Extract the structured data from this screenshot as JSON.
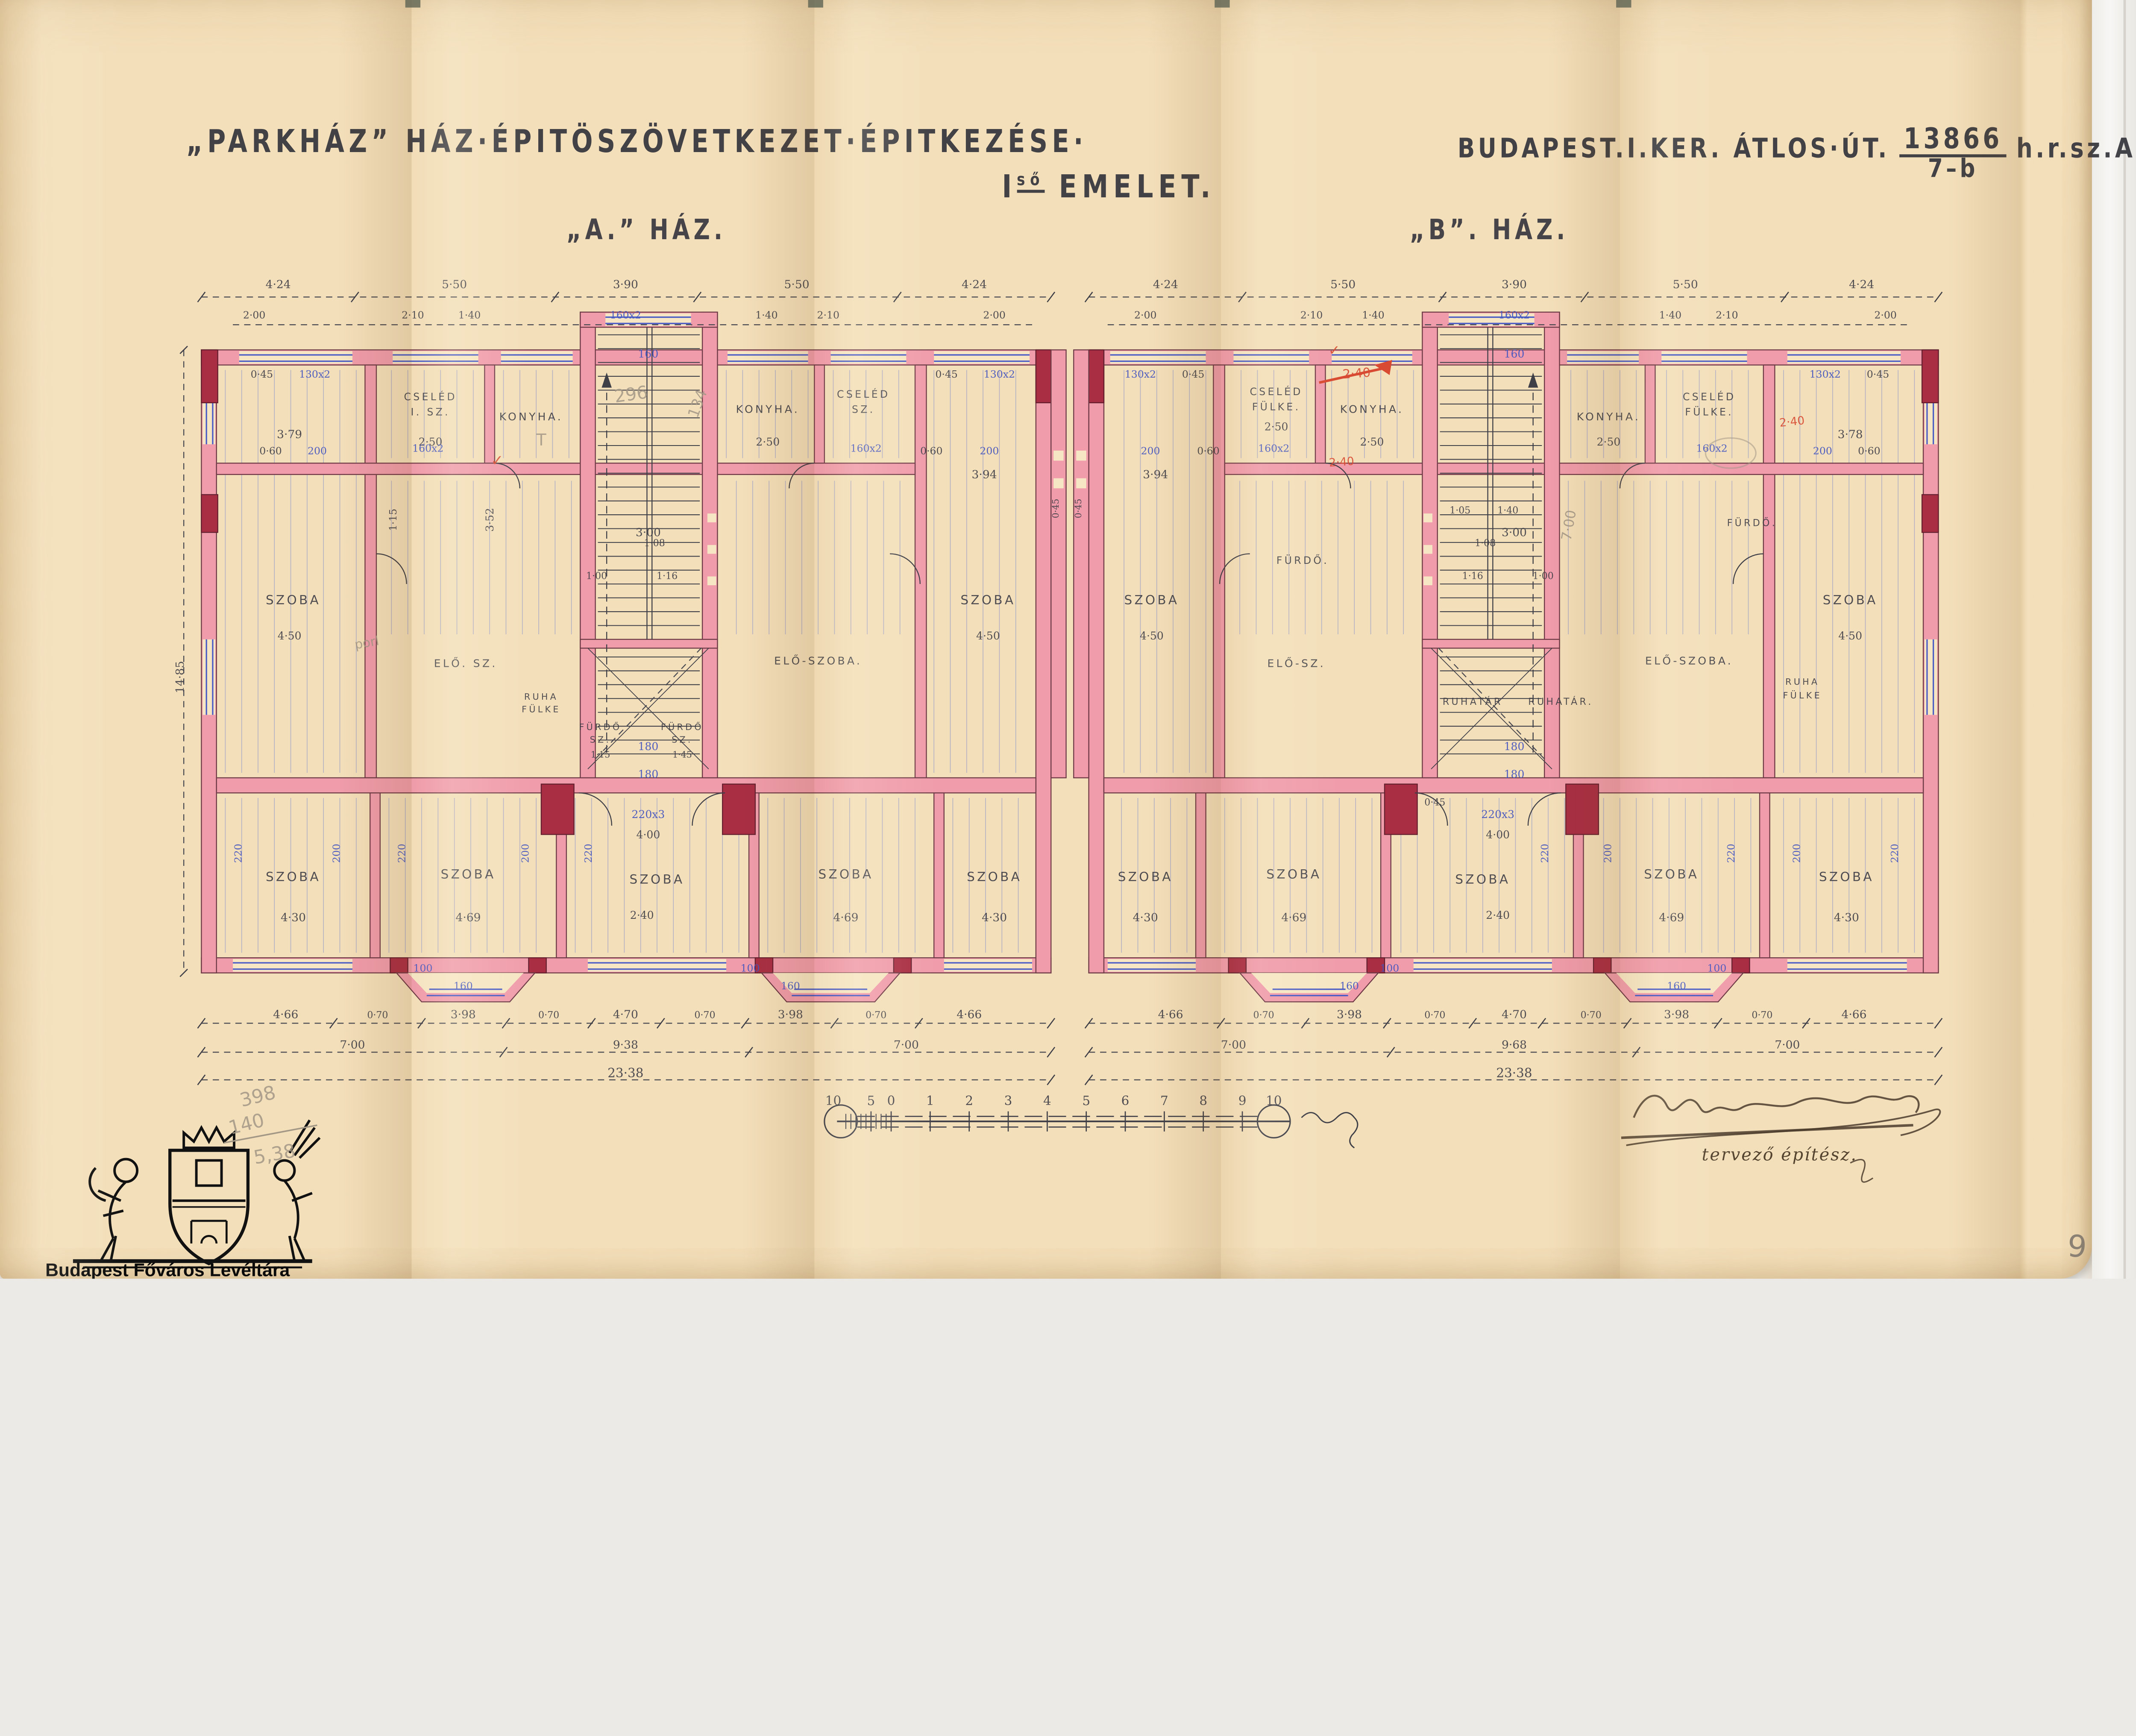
{
  "page": {
    "archive_name": "Budapest Főváros Levéltára",
    "page_number": "9"
  },
  "header": {
    "title": "„PARKHÁZ” HÁZ·ÉPITÖSZÖVETKEZET·ÉPITKEZÉSE·",
    "address": "BUDAPEST.I.KER. ÁTLOS·ÚT.",
    "lot_numerator": "13866",
    "lot_denominator": "7–b",
    "address_suffix": "h.r.sz.A.",
    "floor_main": "I",
    "floor_sup": "ső",
    "floor_rest": "EMELET.",
    "house_a": "„A.” HÁZ.",
    "house_b": "„B”. HÁZ."
  },
  "signature": {
    "role": "tervező építész."
  },
  "pencil_notes": {
    "lines": [
      "398",
      "140",
      "5,38"
    ]
  },
  "scale_bar": {
    "ticks": [
      "10",
      "5",
      "0",
      "1",
      "2",
      "3",
      "4",
      "5",
      "6",
      "7",
      "8",
      "9",
      "10"
    ]
  },
  "plan_labels": [
    [
      "SZOBA",
      103,
      272,
      "m",
      10
    ],
    [
      "SZOBA",
      655,
      272,
      "m",
      10
    ],
    [
      "SZOBA",
      103,
      492,
      "m",
      10
    ],
    [
      "SZOBA",
      242,
      490,
      "m",
      10
    ],
    [
      "SZOBA",
      392,
      494,
      "m",
      10
    ],
    [
      "SZOBA",
      542,
      490,
      "m",
      10
    ],
    [
      "SZOBA",
      660,
      492,
      "m",
      10
    ],
    [
      "CSELÉD",
      212,
      110,
      "m",
      8
    ],
    [
      "I. SZ.",
      212,
      122,
      "m",
      8
    ],
    [
      "KONYHA.",
      292,
      126,
      "m",
      8.5
    ],
    [
      "KONYHA.",
      480,
      120,
      "m",
      8.5
    ],
    [
      "CSELÉD",
      556,
      108,
      "m",
      8
    ],
    [
      "SZ.",
      556,
      120,
      "m",
      8
    ],
    [
      "ELŐ. SZ.",
      240,
      322,
      "m",
      8.5
    ],
    [
      "ELŐ-SZOBA.",
      520,
      320,
      "m",
      8.5
    ],
    [
      "FÜRDŐ",
      347,
      372,
      "m",
      7
    ],
    [
      "SZ.",
      347,
      382,
      "m",
      7
    ],
    [
      "FÜRDŐ",
      412,
      372,
      "m",
      7
    ],
    [
      "SZ.",
      412,
      382,
      "m",
      7
    ],
    [
      "RUHA",
      300,
      348,
      "m",
      7
    ],
    [
      "FÜLKE",
      300,
      358,
      "m",
      7
    ],
    [
      "4·24",
      91,
      21
    ],
    [
      "5·50",
      231,
      21
    ],
    [
      "3·90",
      367,
      21
    ],
    [
      "5·50",
      503,
      21
    ],
    [
      "4·24",
      644,
      21
    ],
    [
      "2·00",
      72,
      45,
      "k",
      8
    ],
    [
      "2·10",
      198,
      45,
      "k",
      8
    ],
    [
      "1·40",
      243,
      45,
      "k",
      8
    ],
    [
      "1·40",
      479,
      45,
      "k",
      8
    ],
    [
      "2·10",
      528,
      45,
      "k",
      8
    ],
    [
      "2·00",
      660,
      45,
      "k",
      8
    ],
    [
      "0·45",
      78,
      92,
      "k",
      8
    ],
    [
      "0·45",
      622,
      92,
      "k",
      8
    ],
    [
      "3·79",
      100,
      140
    ],
    [
      "2·50",
      212,
      146,
      "k",
      8.5
    ],
    [
      "2·50",
      480,
      146,
      "k",
      8.5
    ],
    [
      "3·52",
      262,
      205,
      "k",
      8.5,
      -90
    ],
    [
      "1·15",
      185,
      205,
      "k",
      8,
      -90
    ],
    [
      "3·00",
      385,
      218
    ],
    [
      "0·60",
      85,
      153,
      "k",
      8
    ],
    [
      "0·60",
      610,
      153,
      "k",
      8
    ],
    [
      "3·94",
      652,
      172
    ],
    [
      "4·50",
      100,
      300,
      "k",
      8.5
    ],
    [
      "4·50",
      655,
      300,
      "k",
      8.5
    ],
    [
      "1·08",
      390,
      226,
      "k",
      7.5
    ],
    [
      "1·00",
      344,
      252,
      "k",
      7.5
    ],
    [
      "1·16",
      400,
      252,
      "k",
      7.5
    ],
    [
      "1·15",
      347,
      394,
      "k",
      7
    ],
    [
      "1·45",
      412,
      394,
      "k",
      7
    ],
    [
      "4·00",
      385,
      458,
      "k",
      8.5
    ],
    [
      "4·30",
      103,
      524
    ],
    [
      "4·69",
      242,
      524
    ],
    [
      "2·40",
      380,
      522,
      "k",
      8.5
    ],
    [
      "4·69",
      542,
      524
    ],
    [
      "4·30",
      660,
      524
    ],
    [
      "4·66",
      97,
      601
    ],
    [
      "0·70",
      170,
      601,
      "k",
      7.5
    ],
    [
      "3·98",
      238,
      601
    ],
    [
      "0·70",
      306,
      601,
      "k",
      7.5
    ],
    [
      "4·70",
      367,
      601
    ],
    [
      "0·70",
      430,
      601,
      "k",
      7.5
    ],
    [
      "3·98",
      498,
      601
    ],
    [
      "0·70",
      566,
      601,
      "k",
      7.5
    ],
    [
      "4·66",
      640,
      601
    ],
    [
      "7·00",
      150,
      625
    ],
    [
      "9·38",
      367,
      625
    ],
    [
      "7·00",
      590,
      625
    ],
    [
      "23·38",
      367,
      648,
      "k",
      10
    ],
    [
      "14·85",
      16,
      330,
      "k",
      9,
      -90
    ],
    [
      "0·45",
      711,
      196,
      "k",
      7,
      -90
    ],
    [
      "0·45",
      729,
      196,
      "k",
      7,
      -90
    ],
    [
      "130x2",
      120,
      92,
      "b",
      8
    ],
    [
      "130x2",
      664,
      92,
      "b",
      8
    ],
    [
      "160x2",
      367,
      45,
      "b",
      8
    ],
    [
      "200",
      122,
      153,
      "b",
      8
    ],
    [
      "160x2",
      210,
      151,
      "b",
      8
    ],
    [
      "160x2",
      558,
      151,
      "b",
      8
    ],
    [
      "200",
      656,
      153,
      "b",
      8
    ],
    [
      "160",
      385,
      76,
      "b",
      8.5
    ],
    [
      "180",
      385,
      388,
      "b",
      8.5
    ],
    [
      "180",
      385,
      410,
      "b",
      8.5
    ],
    [
      "220x3",
      385,
      442,
      "b",
      8.5
    ],
    [
      "220",
      62,
      470,
      "b",
      8,
      -90
    ],
    [
      "200",
      140,
      470,
      "b",
      8,
      -90
    ],
    [
      "220",
      192,
      470,
      "b",
      8,
      -90
    ],
    [
      "200",
      290,
      470,
      "b",
      8,
      -90
    ],
    [
      "220",
      340,
      470,
      "b",
      8,
      -90
    ],
    [
      "160",
      238,
      578,
      "b",
      8
    ],
    [
      "100",
      206,
      564,
      "b",
      8
    ],
    [
      "160",
      498,
      578,
      "b",
      8
    ],
    [
      "100",
      466,
      564,
      "b",
      8
    ],
    [
      "296",
      372,
      110,
      "p",
      14,
      -8
    ],
    [
      "134",
      428,
      114,
      "p",
      12,
      -70
    ],
    [
      "T",
      300,
      146,
      "p",
      13
    ],
    [
      "porl",
      162,
      306,
      "p",
      10,
      -10
    ],
    [
      "✓",
      265,
      162,
      "r",
      12
    ],
    [
      "SZOBA",
      1340,
      272,
      "m",
      10
    ],
    [
      "SZOBA",
      785,
      272,
      "m",
      10
    ],
    [
      "SZOBA",
      1337,
      492,
      "m",
      10
    ],
    [
      "SZOBA",
      1198,
      490,
      "m",
      10
    ],
    [
      "SZOBA",
      1048,
      494,
      "m",
      10
    ],
    [
      "SZOBA",
      898,
      490,
      "m",
      10
    ],
    [
      "SZOBA",
      780,
      492,
      "m",
      10
    ],
    [
      "CSELÉD",
      884,
      106,
      "m",
      8
    ],
    [
      "FÜLKE.",
      884,
      118,
      "m",
      8
    ],
    [
      "KONYHA.",
      960,
      120,
      "m",
      8.5
    ],
    [
      "KONYHA.",
      1148,
      126,
      "m",
      8.5
    ],
    [
      "CSELÉD",
      1228,
      110,
      "m",
      8
    ],
    [
      "FÜLKE.",
      1228,
      122,
      "m",
      8
    ],
    [
      "FÜRDŐ.",
      905,
      240,
      "m",
      8
    ],
    [
      "FÜRDŐ.",
      1262,
      210,
      "m",
      7.5
    ],
    [
      "ELŐ-SZ.",
      900,
      322,
      "m",
      8.5
    ],
    [
      "ELŐ-SZOBA.",
      1212,
      320,
      "m",
      8.5
    ],
    [
      "RUHATÁR",
      1040,
      352,
      "m",
      7.5
    ],
    [
      "RUHATÁR.",
      1110,
      352,
      "m",
      7.5
    ],
    [
      "RUHA",
      1302,
      336,
      "m",
      7
    ],
    [
      "FÜLKE",
      1302,
      347,
      "m",
      7
    ],
    [
      "4·24",
      796,
      21
    ],
    [
      "5·50",
      937,
      21
    ],
    [
      "3·90",
      1073,
      21
    ],
    [
      "5·50",
      1209,
      21
    ],
    [
      "4·24",
      1349,
      21
    ],
    [
      "2·00",
      780,
      45,
      "k",
      8
    ],
    [
      "2·10",
      912,
      45,
      "k",
      8
    ],
    [
      "1·40",
      961,
      45,
      "k",
      8
    ],
    [
      "1·40",
      1197,
      45,
      "k",
      8
    ],
    [
      "2·10",
      1242,
      45,
      "k",
      8
    ],
    [
      "2·00",
      1368,
      45,
      "k",
      8
    ],
    [
      "0·45",
      818,
      92,
      "k",
      8
    ],
    [
      "0·45",
      1362,
      92,
      "k",
      8
    ],
    [
      "2·50",
      960,
      146,
      "k",
      8.5
    ],
    [
      "2·50",
      1148,
      146,
      "k",
      8.5
    ],
    [
      "2·50",
      884,
      134,
      "k",
      8.5
    ],
    [
      "3·78",
      1340,
      140
    ],
    [
      "3·00",
      1073,
      218
    ],
    [
      "0·60",
      830,
      153,
      "k",
      8
    ],
    [
      "0·60",
      1355,
      153,
      "k",
      8
    ],
    [
      "3·94",
      788,
      172
    ],
    [
      "4·50",
      785,
      300,
      "k",
      8.5
    ],
    [
      "4·50",
      1340,
      300,
      "k",
      8.5
    ],
    [
      "1·05",
      1030,
      200,
      "k",
      7.5
    ],
    [
      "1·40",
      1068,
      200,
      "k",
      7.5
    ],
    [
      "1·08",
      1050,
      226,
      "k",
      7.5
    ],
    [
      "1·00",
      1096,
      252,
      "k",
      7.5
    ],
    [
      "1·16",
      1040,
      252,
      "k",
      7.5
    ],
    [
      "4·00",
      1060,
      458,
      "k",
      8.5
    ],
    [
      "0·45",
      1010,
      432,
      "k",
      7.5
    ],
    [
      "4·30",
      1337,
      524
    ],
    [
      "4·69",
      1198,
      524
    ],
    [
      "2·40",
      1060,
      522,
      "k",
      8.5
    ],
    [
      "4·69",
      898,
      524
    ],
    [
      "4·30",
      780,
      524
    ],
    [
      "4·66",
      1343,
      601
    ],
    [
      "0·70",
      1270,
      601,
      "k",
      7.5
    ],
    [
      "3·98",
      1202,
      601
    ],
    [
      "0·70",
      1134,
      601,
      "k",
      7.5
    ],
    [
      "4·70",
      1073,
      601
    ],
    [
      "0·70",
      1010,
      601,
      "k",
      7.5
    ],
    [
      "3·98",
      942,
      601
    ],
    [
      "0·70",
      874,
      601,
      "k",
      7.5
    ],
    [
      "4·66",
      800,
      601
    ],
    [
      "7·00",
      850,
      625
    ],
    [
      "9·68",
      1073,
      625
    ],
    [
      "7·00",
      1290,
      625
    ],
    [
      "23·38",
      1073,
      648,
      "k",
      10
    ],
    [
      "130x2",
      1320,
      92,
      "b",
      8
    ],
    [
      "130x2",
      776,
      92,
      "b",
      8
    ],
    [
      "160x2",
      1073,
      45,
      "b",
      8
    ],
    [
      "200",
      1318,
      153,
      "b",
      8
    ],
    [
      "160x2",
      1230,
      151,
      "b",
      8
    ],
    [
      "160x2",
      882,
      151,
      "b",
      8
    ],
    [
      "200",
      784,
      153,
      "b",
      8
    ],
    [
      "160",
      1073,
      76,
      "b",
      8.5
    ],
    [
      "180",
      1073,
      388,
      "b",
      8.5
    ],
    [
      "180",
      1073,
      410,
      "b",
      8.5
    ],
    [
      "220x3",
      1060,
      442,
      "b",
      8.5
    ],
    [
      "220",
      1378,
      470,
      "b",
      8,
      -90
    ],
    [
      "200",
      1300,
      470,
      "b",
      8,
      -90
    ],
    [
      "220",
      1248,
      470,
      "b",
      8,
      -90
    ],
    [
      "200",
      1150,
      470,
      "b",
      8,
      -90
    ],
    [
      "220",
      1100,
      470,
      "b",
      8,
      -90
    ],
    [
      "160",
      1202,
      578,
      "b",
      8
    ],
    [
      "100",
      1234,
      564,
      "b",
      8
    ],
    [
      "160",
      942,
      578,
      "b",
      8
    ],
    [
      "100",
      974,
      564,
      "b",
      8
    ],
    [
      "7·00",
      1120,
      210,
      "p",
      11,
      -80
    ],
    [
      "2·40",
      948,
      92,
      "r",
      10,
      -4
    ],
    [
      "2·40",
      936,
      162,
      "r",
      9,
      -4
    ],
    [
      "2·40",
      1294,
      130,
      "r",
      9,
      -6
    ],
    [
      "✓",
      930,
      74,
      "r",
      11
    ]
  ]
}
